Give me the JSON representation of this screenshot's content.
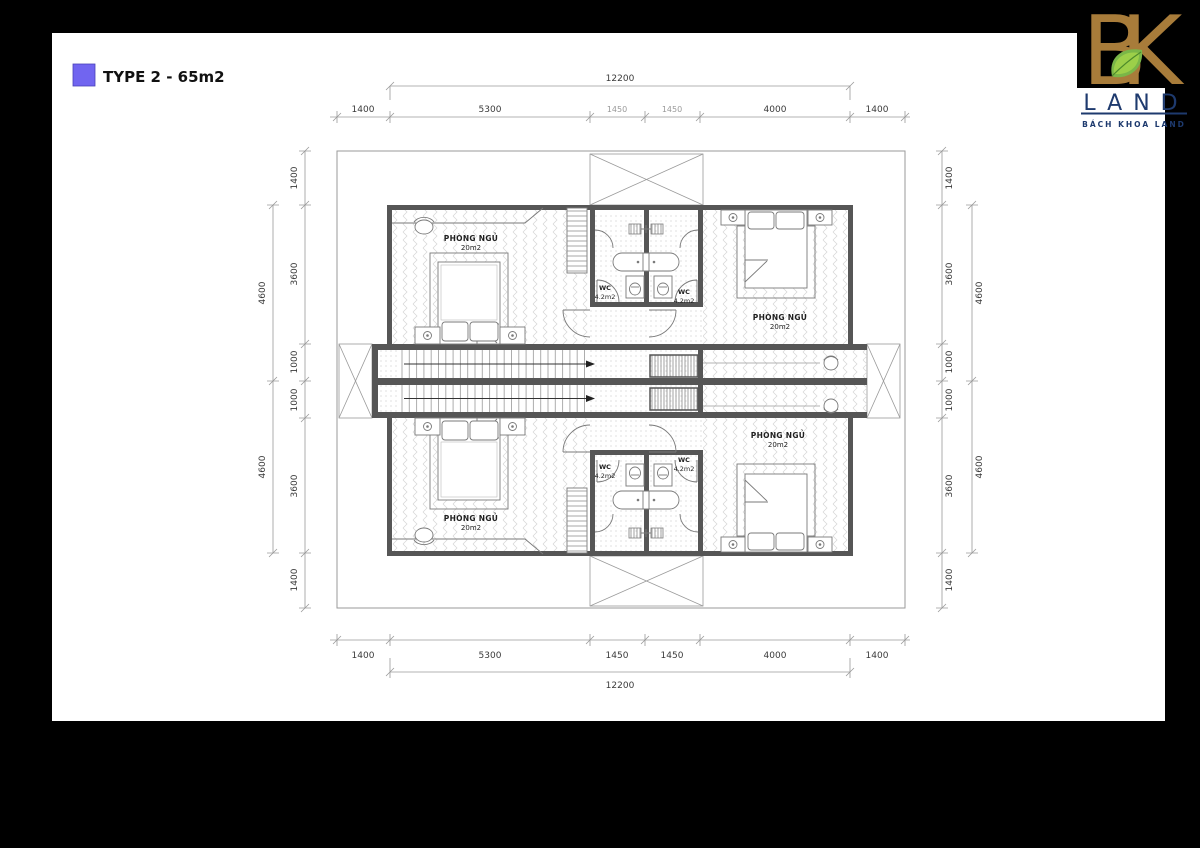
{
  "page": {
    "background": "#000000",
    "paper": "#ffffff"
  },
  "legend": {
    "label": "TYPE 2 - 65m2",
    "swatch_color": "#7165f0"
  },
  "logo": {
    "monogram": "BK",
    "brand": "LAND",
    "subtitle": "BÁCH KHOA LAND",
    "gold": "#a87c3a",
    "navy": "#1e3a6e",
    "leaf": "#7ab648"
  },
  "dims": {
    "horizontal": {
      "total": "12200",
      "segments": [
        "1400",
        "5300",
        "1450",
        "1450",
        "4000",
        "1400"
      ]
    },
    "vertical": {
      "segments": [
        "1400",
        "3600",
        "1000",
        "1000",
        "3600",
        "1400"
      ],
      "outer": [
        "4600",
        "4600"
      ]
    }
  },
  "rooms": {
    "bedroom": {
      "name": "PHÒNG NGỦ",
      "area": "20m2"
    },
    "wc": {
      "name": "WC",
      "area": "4.2m2"
    }
  }
}
